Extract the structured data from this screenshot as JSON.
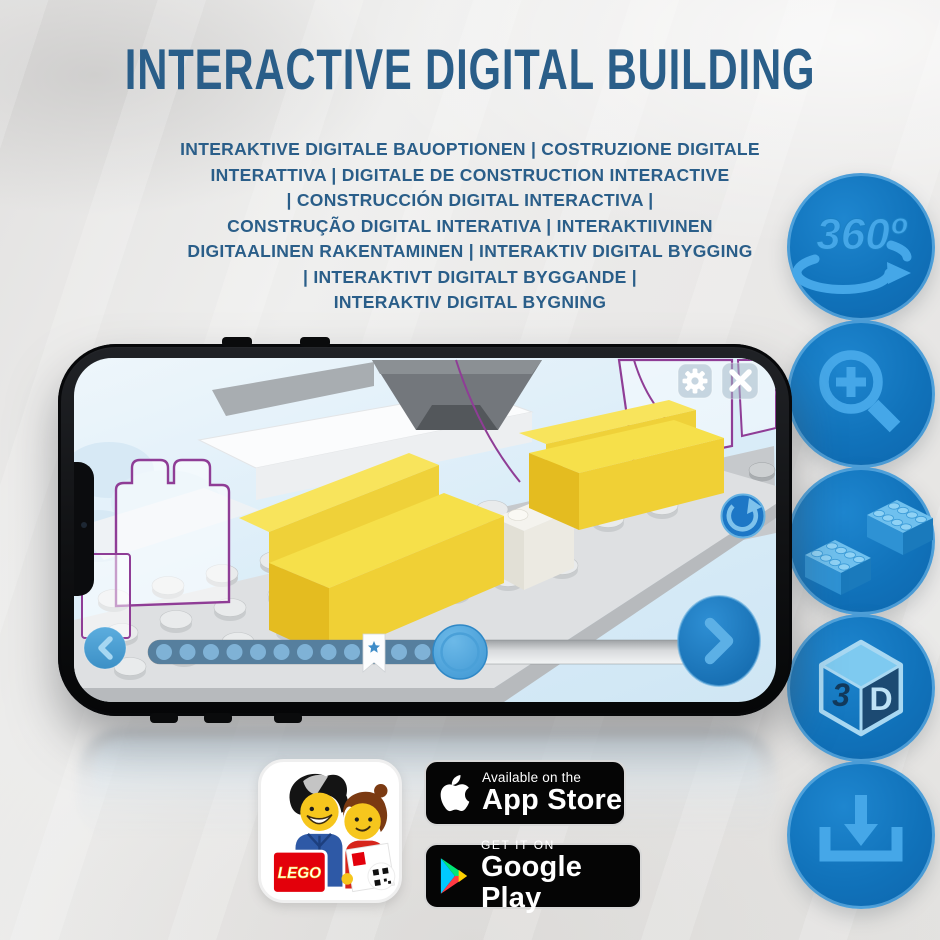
{
  "header": {
    "title": "INTERACTIVE DIGITAL BUILDING",
    "subtitle_lines": [
      "INTERAKTIVE DIGITALE BAUOPTIONEN | COSTRUZIONE DIGITALE",
      "INTERATTIVA | DIGITALE DE CONSTRUCTION INTERACTIVE",
      "| CONSTRUCCIÓN DIGITAL INTERACTIVA |",
      "CONSTRUÇÃO DIGITAL INTERATIVA | INTERAKTIIVINEN",
      "DIGITAALINEN RAKENTAMINEN | INTERAKTIV DIGITAL BYGGING",
      "| INTERAKTIVT DIGITALT BYGGANDE |",
      "INTERAKTIV DIGITAL BYGNING"
    ]
  },
  "feature_rail": {
    "icons": [
      {
        "name": "360-rotation-icon",
        "label": "360º"
      },
      {
        "name": "zoom-in-icon"
      },
      {
        "name": "bricks-icon"
      },
      {
        "name": "3d-cube-icon",
        "left_face": "3",
        "right_face": "D"
      },
      {
        "name": "download-icon"
      }
    ]
  },
  "phone": {
    "screen_ui": {
      "top_right_buttons": [
        "settings-gear",
        "close"
      ],
      "rotate_button": "rotate-reset",
      "prev_button": "chevron-left",
      "next_button": "chevron-right",
      "slider": {
        "progress_percent": 53,
        "bookmark_percent": 38
      }
    }
  },
  "badges": {
    "lego_app": {
      "logo_text": "LEGO"
    },
    "app_store": {
      "tagline": "Available on the",
      "store_name": "App Store"
    },
    "google_play": {
      "tagline": "GET IT ON",
      "store_name": "Google Play"
    }
  },
  "colors": {
    "heading_blue": "#2a5e89",
    "circle_blue": "#1173bb",
    "icon_light_blue": "#45a7e8",
    "screen_sky": "#d9ecf8",
    "sofa_yellow": "#f2d63c",
    "ghost_outline_purple": "#8f3d96",
    "badge_black": "#050505",
    "play_cyan": "#00c9ff",
    "play_green": "#00e676",
    "play_red": "#ff3a44",
    "play_yellow": "#ffd000",
    "lego_red": "#e3000b"
  }
}
